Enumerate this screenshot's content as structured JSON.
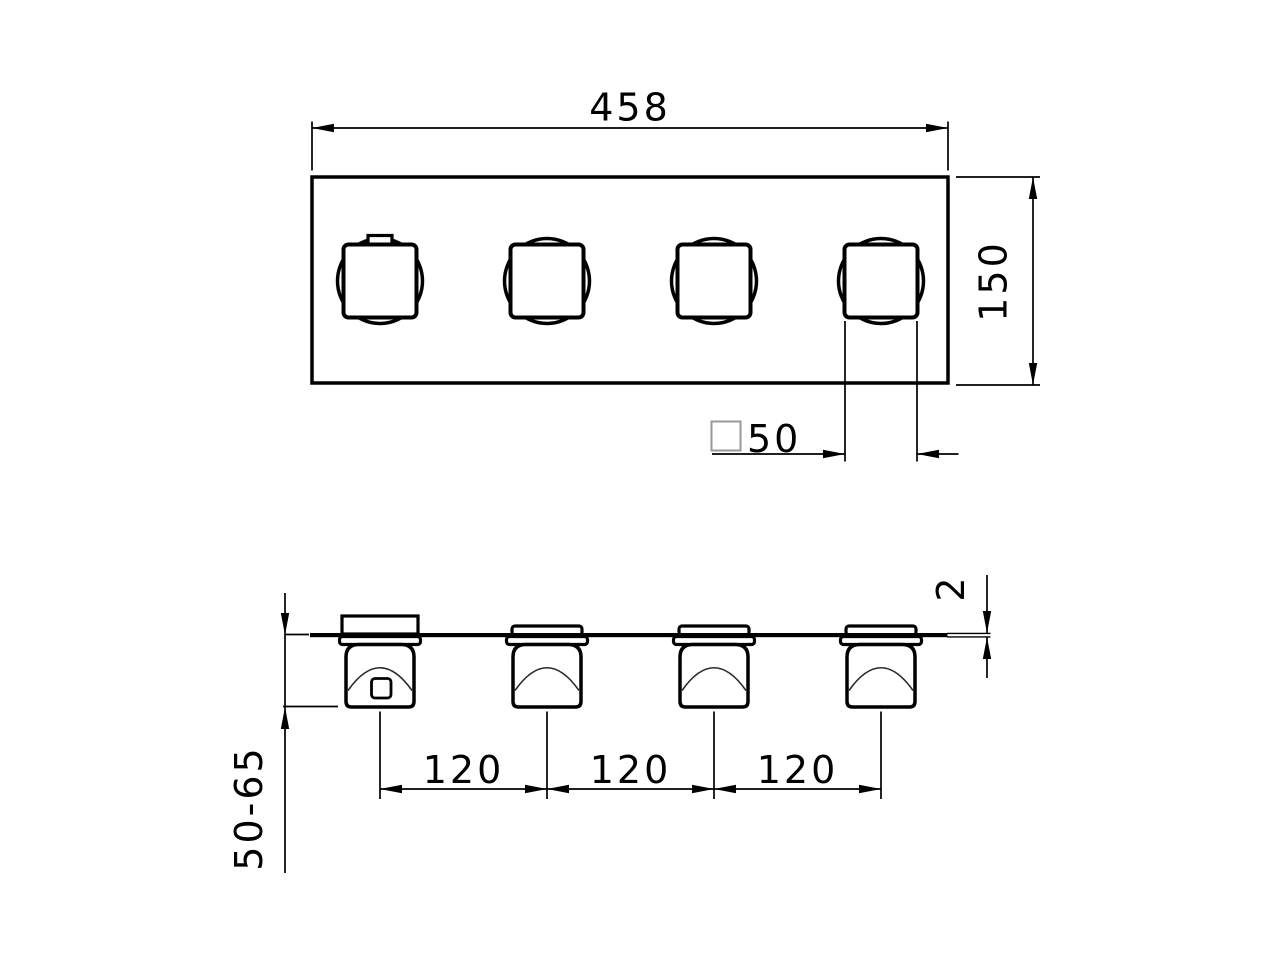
{
  "drawing": {
    "kind": "technical-dimension-drawing",
    "views": {
      "front": "front view of rectangular plate with 4 square handles",
      "bottom": "bottom profile view of plate with 4 handle bodies"
    },
    "colors": {
      "line": "#000000",
      "background": "#ffffff",
      "symbol_gray": "#999999"
    },
    "icons": {
      "square_symbol": "square-symbol"
    }
  },
  "labels": {
    "overall_width": "458",
    "overall_height": "150",
    "handle_square_size": "50",
    "handle_spacings": [
      "120",
      "120",
      "120"
    ],
    "depth_range": "50-65",
    "plate_thickness": "2"
  }
}
